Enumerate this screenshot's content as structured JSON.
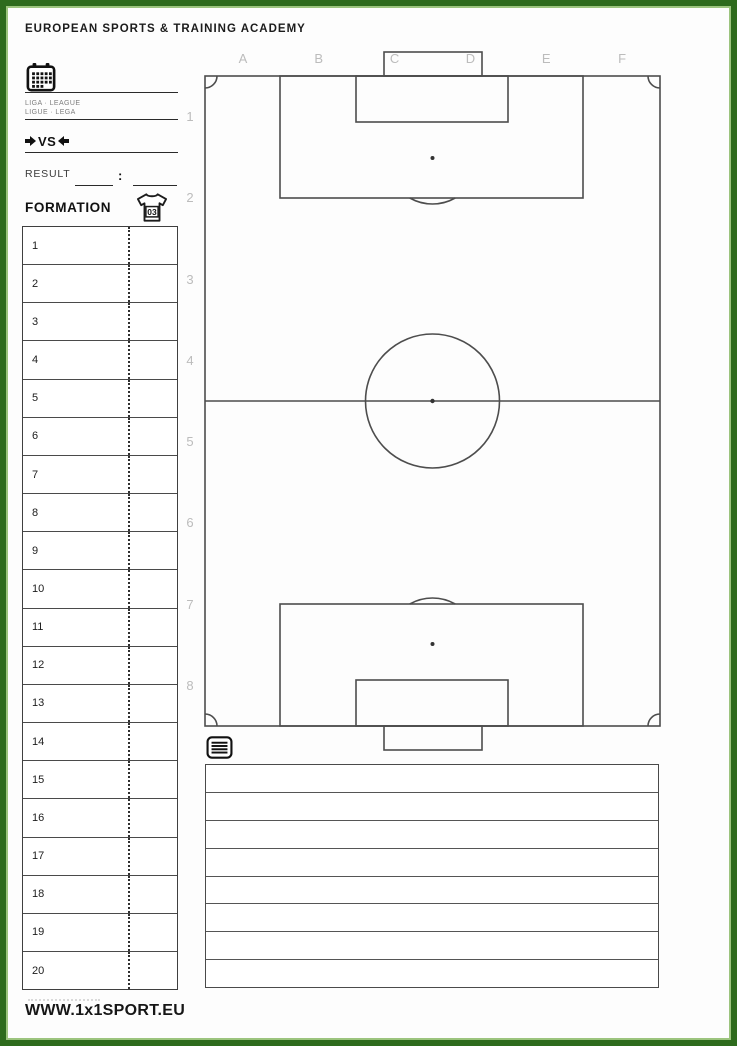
{
  "header": {
    "brand": "EUROPEAN SPORTS & TRAINING ACADEMY"
  },
  "match": {
    "league_line1": "LIGA · LEAGUE",
    "league_line2": "LIGUE · LEGA",
    "versus": "VS",
    "result_label": "RESULT",
    "result_colon": ":"
  },
  "formation": {
    "title": "FORMATION",
    "jersey_number": "03",
    "positions": [
      "1",
      "2",
      "3",
      "4",
      "5",
      "6",
      "7",
      "8",
      "9",
      "10",
      "11",
      "12",
      "13",
      "14",
      "15",
      "16",
      "17",
      "18",
      "19",
      "20"
    ]
  },
  "pitch": {
    "column_labels": [
      "A",
      "B",
      "C",
      "D",
      "E",
      "F"
    ],
    "row_labels": [
      "1",
      "2",
      "3",
      "4",
      "5",
      "6",
      "7",
      "8"
    ]
  },
  "notes": {
    "lines": [
      "",
      "",
      "",
      "",
      "",
      "",
      "",
      ""
    ]
  },
  "footer": {
    "website": "WWW.1x1SPORT.EU"
  },
  "colors": {
    "frame_outer_green": "#2e6b1d",
    "frame_inner_green": "#9cc47e",
    "pitch_line": "#4d4d4d",
    "grid_label_gray": "#bcbcbc",
    "ink": "#1c1c1c"
  }
}
